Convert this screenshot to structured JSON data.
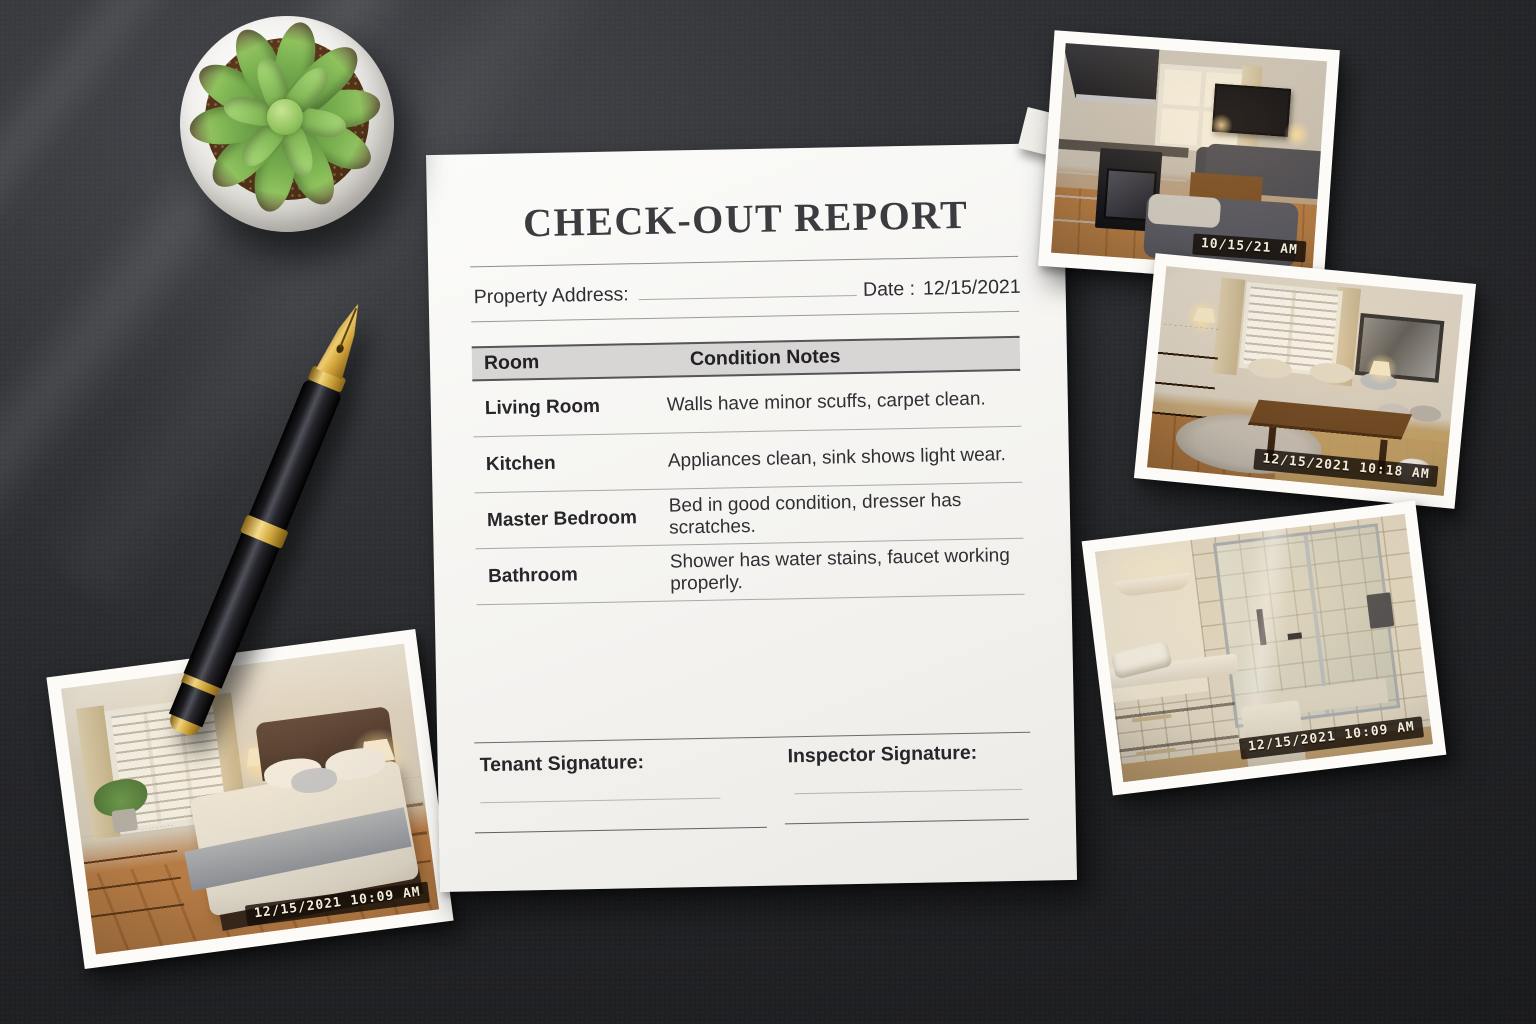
{
  "document": {
    "title": "CHECK-OUT REPORT",
    "property_address_label": "Property Address:",
    "date_label": "Date :",
    "date_value": "12/15/2021",
    "table": {
      "headers": [
        "Room",
        "Condition Notes"
      ],
      "rows": [
        {
          "room": "Living Room",
          "notes": "Walls have minor scuffs, carpet clean."
        },
        {
          "room": "Kitchen",
          "notes": "Appliances clean, sink shows light wear."
        },
        {
          "room": "Master Bedroom",
          "notes": "Bed in good condition, dresser has scratches."
        },
        {
          "room": "Bathroom",
          "notes": "Shower has water stains, faucet working properly."
        }
      ]
    },
    "tenant_signature_label": "Tenant Signature:",
    "inspector_signature_label": "Inspector Signature:"
  },
  "photos": [
    {
      "subject": "kitchen-living-room",
      "timestamp": "10/15/21 AM"
    },
    {
      "subject": "living-room",
      "timestamp": "12/15/2021 10:18 AM"
    },
    {
      "subject": "bathroom",
      "timestamp": "12/15/2021 10:09 AM"
    },
    {
      "subject": "bedroom",
      "timestamp": "12/15/2021 10:09 AM"
    }
  ],
  "scene": {
    "objects": [
      "succulent-plant",
      "fountain-pen",
      "checkout-report-paper",
      "room-photos"
    ],
    "colors": {
      "desk": "#232428",
      "paper": "#f6f5f2",
      "table_header_bg": "#d7d6d4",
      "pen_gold": "#d4a73c",
      "timestamp_text": "#f4ecd7"
    }
  }
}
